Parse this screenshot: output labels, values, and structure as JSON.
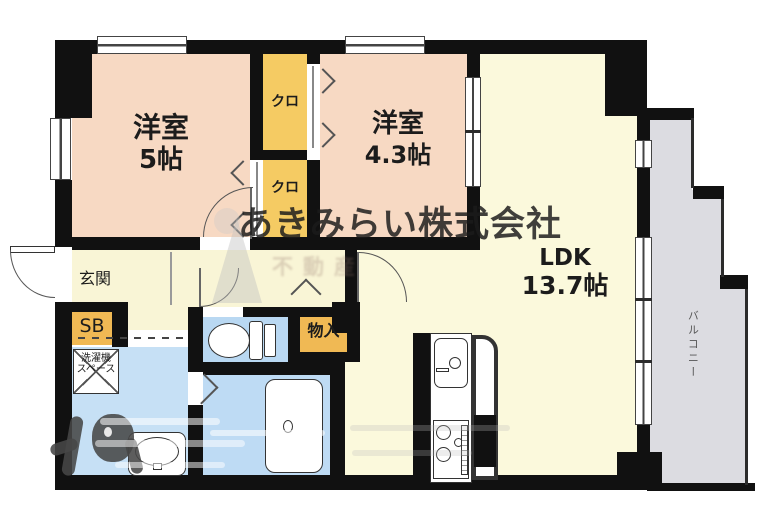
{
  "plan_title": "1LDK-floor-plan",
  "rooms": {
    "bedroom1": {
      "name": "洋室",
      "size": "5帖"
    },
    "bedroom2": {
      "name": "洋室",
      "size": "4.3帖"
    },
    "ldk": {
      "name": "LDK",
      "size": "13.7帖"
    },
    "closet_upper": {
      "name": "クロ"
    },
    "closet_lower": {
      "name": "クロ"
    },
    "entrance": {
      "name": "玄関"
    },
    "shoe_box": {
      "name": "SB"
    },
    "storage": {
      "name": "物入"
    },
    "laundry": {
      "line1": "洗濯機",
      "line2": "スペース"
    },
    "balcony": {
      "name": "バルコニー"
    }
  },
  "watermark": {
    "line1": "あきみらい株式会社",
    "line2": "不動産"
  },
  "colors": {
    "wall": "#111111",
    "bedroom": "#f7d9c3",
    "closet": "#f5cb63",
    "shoe_storage": "#f0b954",
    "ldk": "#fbf9dc",
    "hall": "#f9f5d6",
    "washroom": "#c6e0f5",
    "toilet": "#b9d8f2",
    "bath": "#bedbf4",
    "balcony": "#dcdce1"
  }
}
